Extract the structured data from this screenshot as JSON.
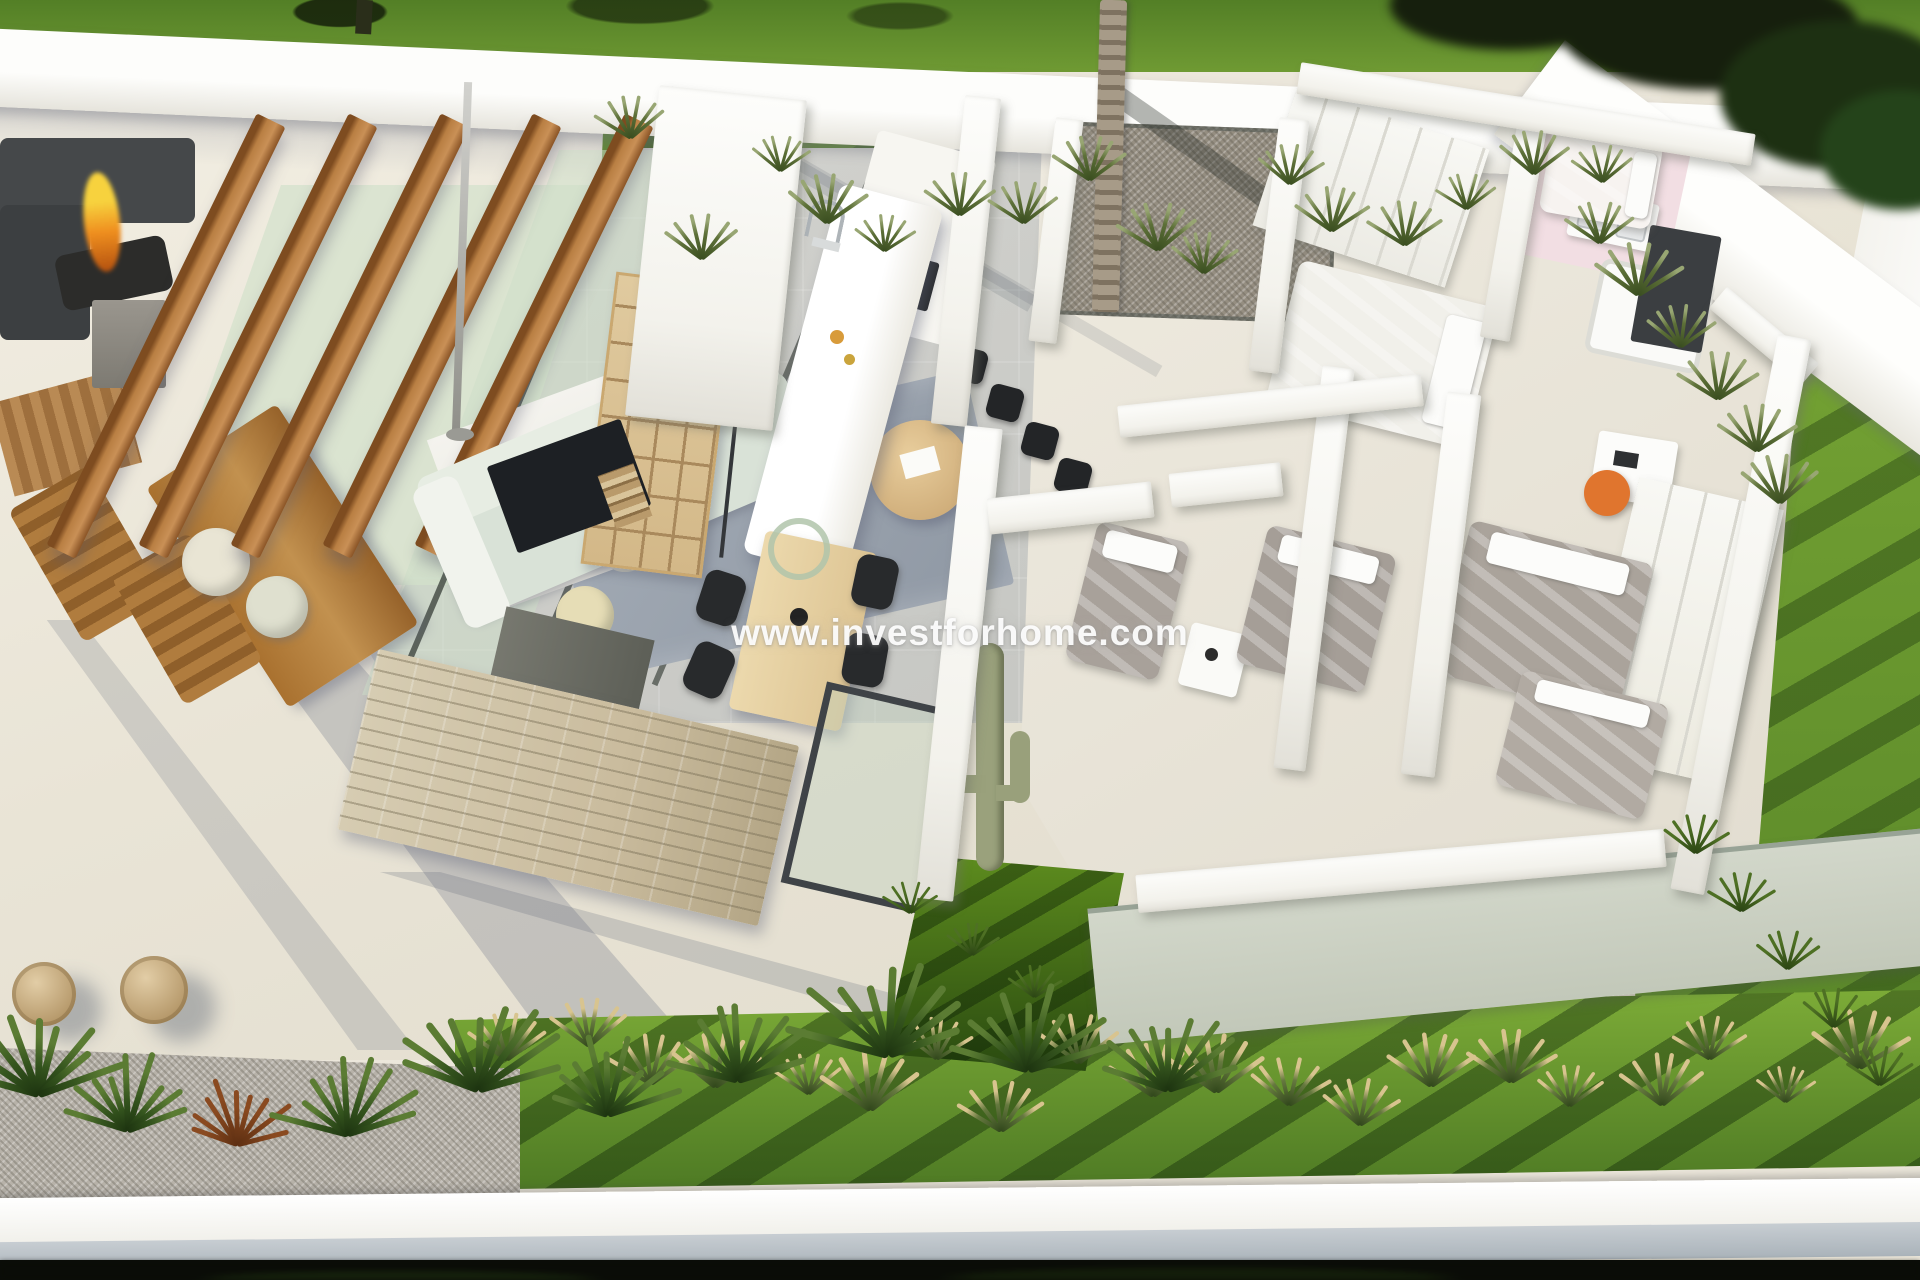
{
  "watermark": {
    "text": "www.investforhome.com"
  },
  "colors": {
    "terrace": "#ece7db",
    "wall": "#f7f6f2",
    "lawn": "#79a635",
    "lawnShade": "#43671f",
    "foliage": "#161f0d",
    "glass": "#cdddc5",
    "wood": "#b5763c",
    "woodLight": "#e4d0a3",
    "rug": "#99a1ad",
    "sofa": "#d9e2d7",
    "stone": "#cabc9e",
    "bedGray": "#a8a19a",
    "bedWhite": "#f1f0ea",
    "pink": "#f2dee3",
    "orange": "#e0752e",
    "flame": "#ef8f1f",
    "gravel": "#b7b2a9",
    "darkUnit": "#3b3e41",
    "wm": "rgba(255,255,255,0.92)"
  }
}
